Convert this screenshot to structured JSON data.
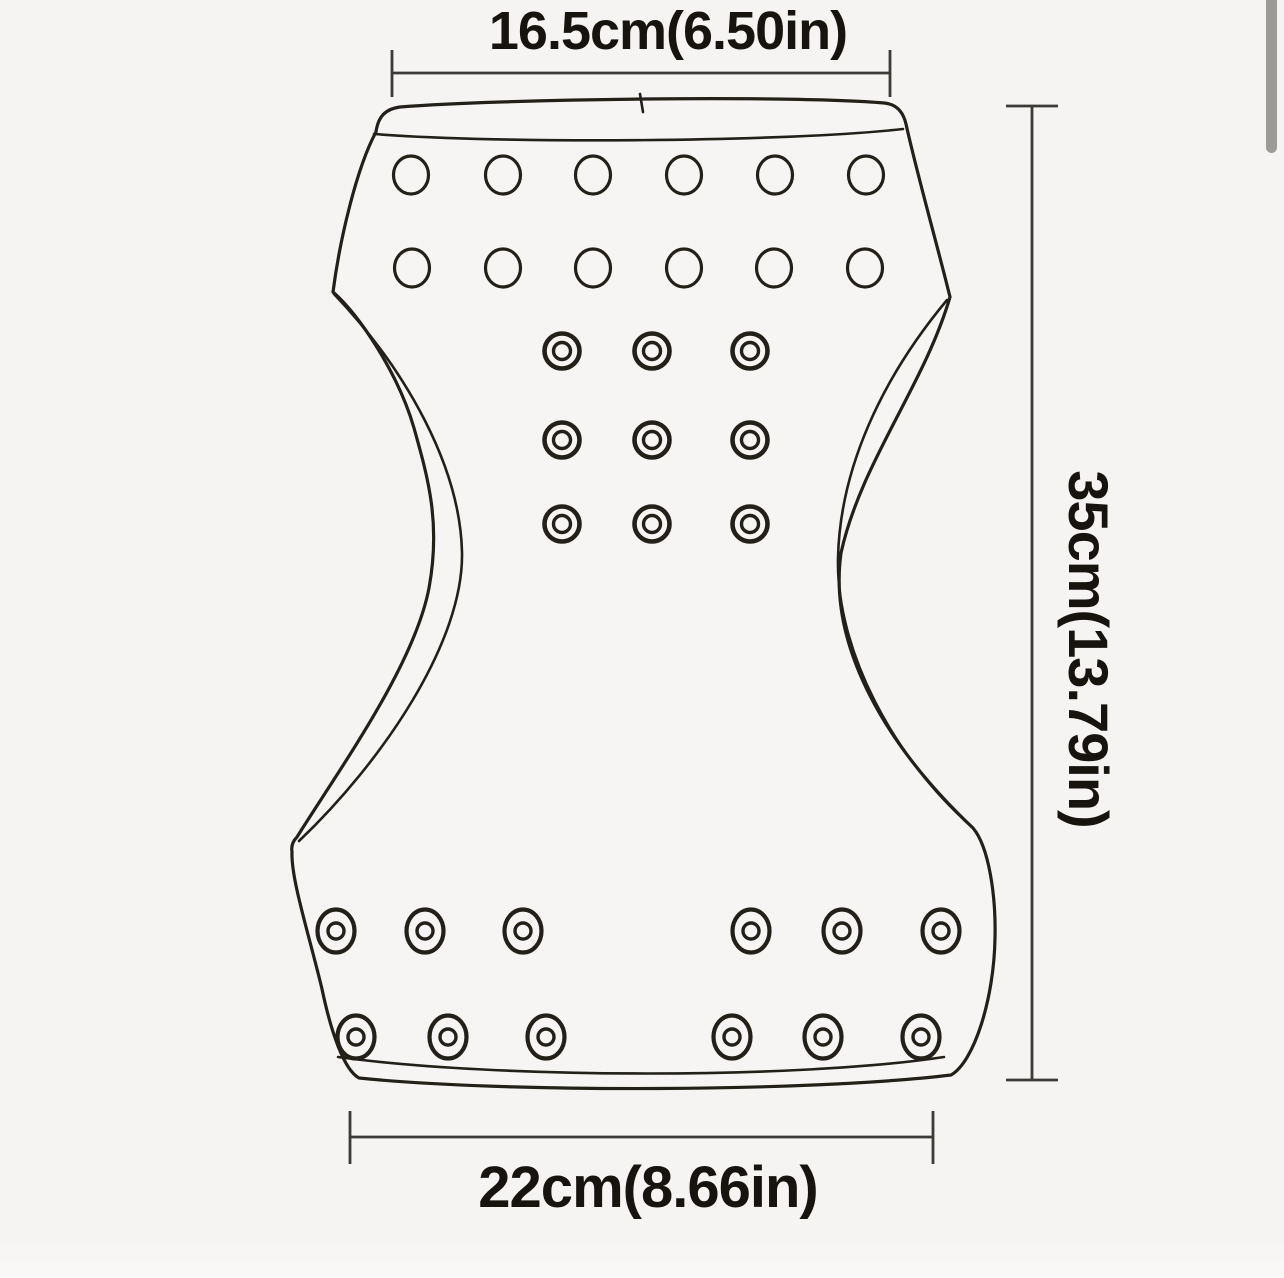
{
  "canvas": {
    "width": 1284,
    "height": 1278,
    "background": "#f5f4f2",
    "shape_fill": "#f6f5f3",
    "line_color": "#232019",
    "dim_line_color": "#3c3a36",
    "text_color": "#17140f",
    "scrollbar_color": "#9c9b97"
  },
  "diagram": {
    "description": "technical outline drawing of an hourglass-shaped pad with ventilation holes, snap buttons and grommets, annotated with dimensions",
    "dimensions": {
      "top": "16.5cm(6.50in)",
      "right": "35cm(13.79in)",
      "bottom": "22cm(8.66in)"
    },
    "holes": {
      "top_vent_rows": [
        {
          "y": 175,
          "xs": [
            411,
            503,
            593,
            684,
            775,
            866
          ]
        },
        {
          "y": 268,
          "xs": [
            412,
            503,
            593,
            684,
            774,
            865
          ]
        }
      ],
      "center_snap_rows": [
        {
          "y": 351,
          "xs": [
            562,
            652,
            750
          ]
        },
        {
          "y": 440,
          "xs": [
            562,
            652,
            750
          ]
        },
        {
          "y": 524,
          "xs": [
            562,
            652,
            750
          ]
        }
      ],
      "bottom_grommet_rows": [
        {
          "y": 931,
          "xs": [
            336,
            425,
            523,
            751,
            842,
            941
          ]
        },
        {
          "y": 1037,
          "xs": [
            356,
            448,
            546,
            732,
            823,
            921
          ]
        }
      ]
    }
  }
}
